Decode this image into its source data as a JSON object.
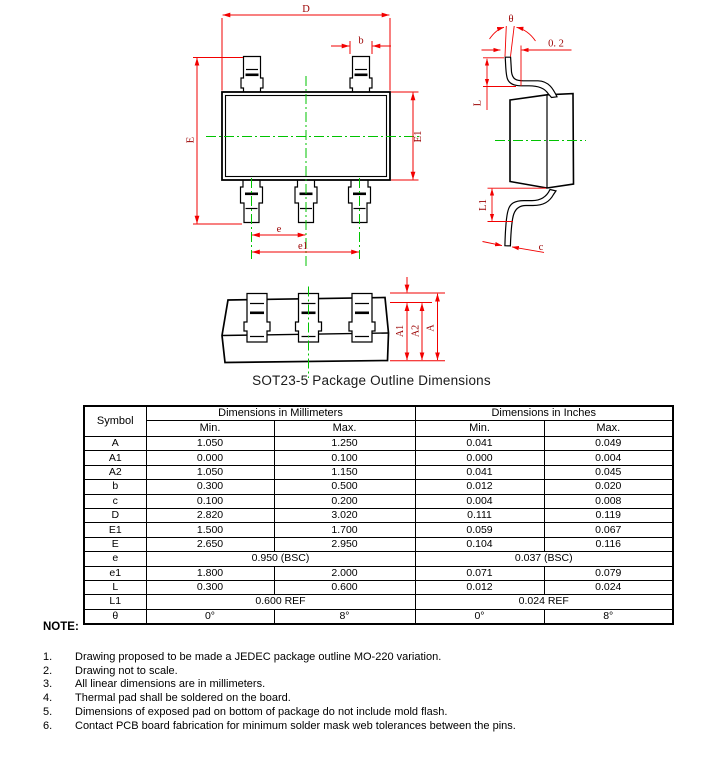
{
  "drawing": {
    "caption": "SOT23-5 Package Outline Dimensions",
    "labels": {
      "D": "D",
      "b": "b",
      "E": "E",
      "E1": "E1",
      "e": "e",
      "e1": "e1",
      "theta": "θ",
      "gap": "0. 2",
      "L": "L",
      "L1": "L1",
      "c": "c",
      "A": "A",
      "A1": "A1",
      "A2": "A2"
    },
    "colors": {
      "dimension_line": "#f20000",
      "dimension_label": "#9b0000",
      "centerline": "#00c300",
      "outline": "#000000"
    }
  },
  "table": {
    "header": {
      "symbol": "Symbol",
      "mm": "Dimensions in Millimeters",
      "inch": "Dimensions in Inches",
      "min": "Min.",
      "max": "Max."
    },
    "rows": [
      {
        "symbol": "A",
        "mm_min": "1.050",
        "mm_max": "1.250",
        "in_min": "0.041",
        "in_max": "0.049"
      },
      {
        "symbol": "A1",
        "mm_min": "0.000",
        "mm_max": "0.100",
        "in_min": "0.000",
        "in_max": "0.004"
      },
      {
        "symbol": "A2",
        "mm_min": "1.050",
        "mm_max": "1.150",
        "in_min": "0.041",
        "in_max": "0.045"
      },
      {
        "symbol": "b",
        "mm_min": "0.300",
        "mm_max": "0.500",
        "in_min": "0.012",
        "in_max": "0.020"
      },
      {
        "symbol": "c",
        "mm_min": "0.100",
        "mm_max": "0.200",
        "in_min": "0.004",
        "in_max": "0.008"
      },
      {
        "symbol": "D",
        "mm_min": "2.820",
        "mm_max": "3.020",
        "in_min": "0.111",
        "in_max": "0.119"
      },
      {
        "symbol": "E1",
        "mm_min": "1.500",
        "mm_max": "1.700",
        "in_min": "0.059",
        "in_max": "0.067"
      },
      {
        "symbol": "E",
        "mm_min": "2.650",
        "mm_max": "2.950",
        "in_min": "0.104",
        "in_max": "0.116"
      },
      {
        "symbol": "e",
        "mm_span": "0.950 (BSC)",
        "in_span": "0.037 (BSC)"
      },
      {
        "symbol": "e1",
        "mm_min": "1.800",
        "mm_max": "2.000",
        "in_min": "0.071",
        "in_max": "0.079"
      },
      {
        "symbol": "L",
        "mm_min": "0.300",
        "mm_max": "0.600",
        "in_min": "0.012",
        "in_max": "0.024"
      },
      {
        "symbol": "L1",
        "mm_span": "0.600 REF",
        "in_span": "0.024 REF"
      },
      {
        "symbol": "θ",
        "mm_min": "0°",
        "mm_max": "8°",
        "in_min": "0°",
        "in_max": "8°"
      }
    ]
  },
  "notes": {
    "heading": "NOTE:",
    "items": [
      {
        "num": "1.",
        "text": "Drawing proposed to be made a JEDEC package outline MO-220 variation."
      },
      {
        "num": "2.",
        "text": "Drawing not to scale."
      },
      {
        "num": "3.",
        "text": "All linear dimensions are in millimeters."
      },
      {
        "num": "4.",
        "text": "Thermal pad shall be soldered on the board."
      },
      {
        "num": "5.",
        "text": "Dimensions of exposed pad on bottom of package do not include mold flash."
      },
      {
        "num": "6.",
        "text": "Contact PCB board fabrication for minimum solder mask web tolerances between the pins."
      }
    ]
  }
}
